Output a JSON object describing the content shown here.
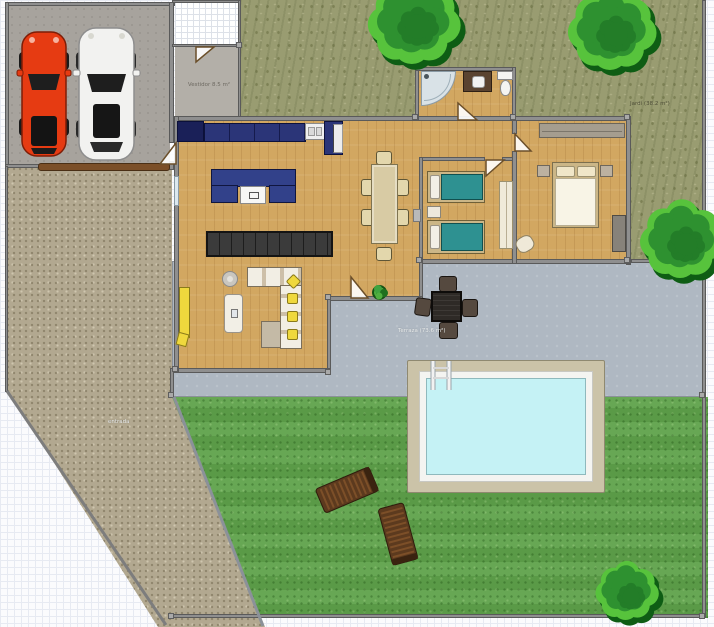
{
  "canvas": {
    "width": 714,
    "height": 627
  },
  "labels": {
    "vestibule": "Vestidor 8.5 m²",
    "terrace": "Terraza (73.6 m²)",
    "side_garden": "Jardí (38.2 m²)",
    "driveway": "entrada"
  },
  "colors": {
    "wood": "#D2A761",
    "wall": "#8F8F8F",
    "wall_edge": "#5A5A5A",
    "scrub": "#999C71",
    "lawn": "#5FA24B",
    "patio": "#AFB8C2",
    "gravel": "#B2A890",
    "garage_floor": "#A7A39D",
    "vestibule_floor": "#B3AFA8",
    "kitchen_navy": "#2B3578",
    "fridge_navy": "#1A2058",
    "sofa_navy": "#32418A",
    "sideboard": "#3B3B3B",
    "table_cream": "#D8CBA4",
    "chair_cream": "#E3D7AC",
    "bed_teal": "#2E9191",
    "frame_tan": "#CBB687",
    "duvet_white": "#F8F4E6",
    "pillow_cream": "#F0E6C8",
    "pool_deck": "#CBC3A8",
    "pool_rim": "#F4F4F1",
    "pool_water": "#C5F2F5",
    "tree_shadow": "#0E5D14",
    "tree_light": "#57C33C",
    "tree_mid": "#2E9130",
    "tree_dark": "#237D28",
    "car_red": "#E63B12",
    "car_white": "#F2F2F0",
    "glass": "#1E1E1E",
    "lounger_wood": "#5C3A1E",
    "outdoor_dark": "#2E2A26",
    "outdoor_chair": "#55493F",
    "accent_yellow": "#EFD83D",
    "door_brown": "#7B4F28"
  },
  "objects": {
    "trees": [
      {
        "cx": 414,
        "cy": 20,
        "r": 44
      },
      {
        "cx": 612,
        "cy": 28,
        "r": 42
      },
      {
        "cx": 682,
        "cy": 238,
        "r": 40
      },
      {
        "cx": 627,
        "cy": 590,
        "r": 30
      }
    ],
    "loungers": [
      {
        "cx": 347,
        "cy": 490,
        "angle": -23
      },
      {
        "cx": 398,
        "cy": 534,
        "angle": 75
      }
    ]
  }
}
